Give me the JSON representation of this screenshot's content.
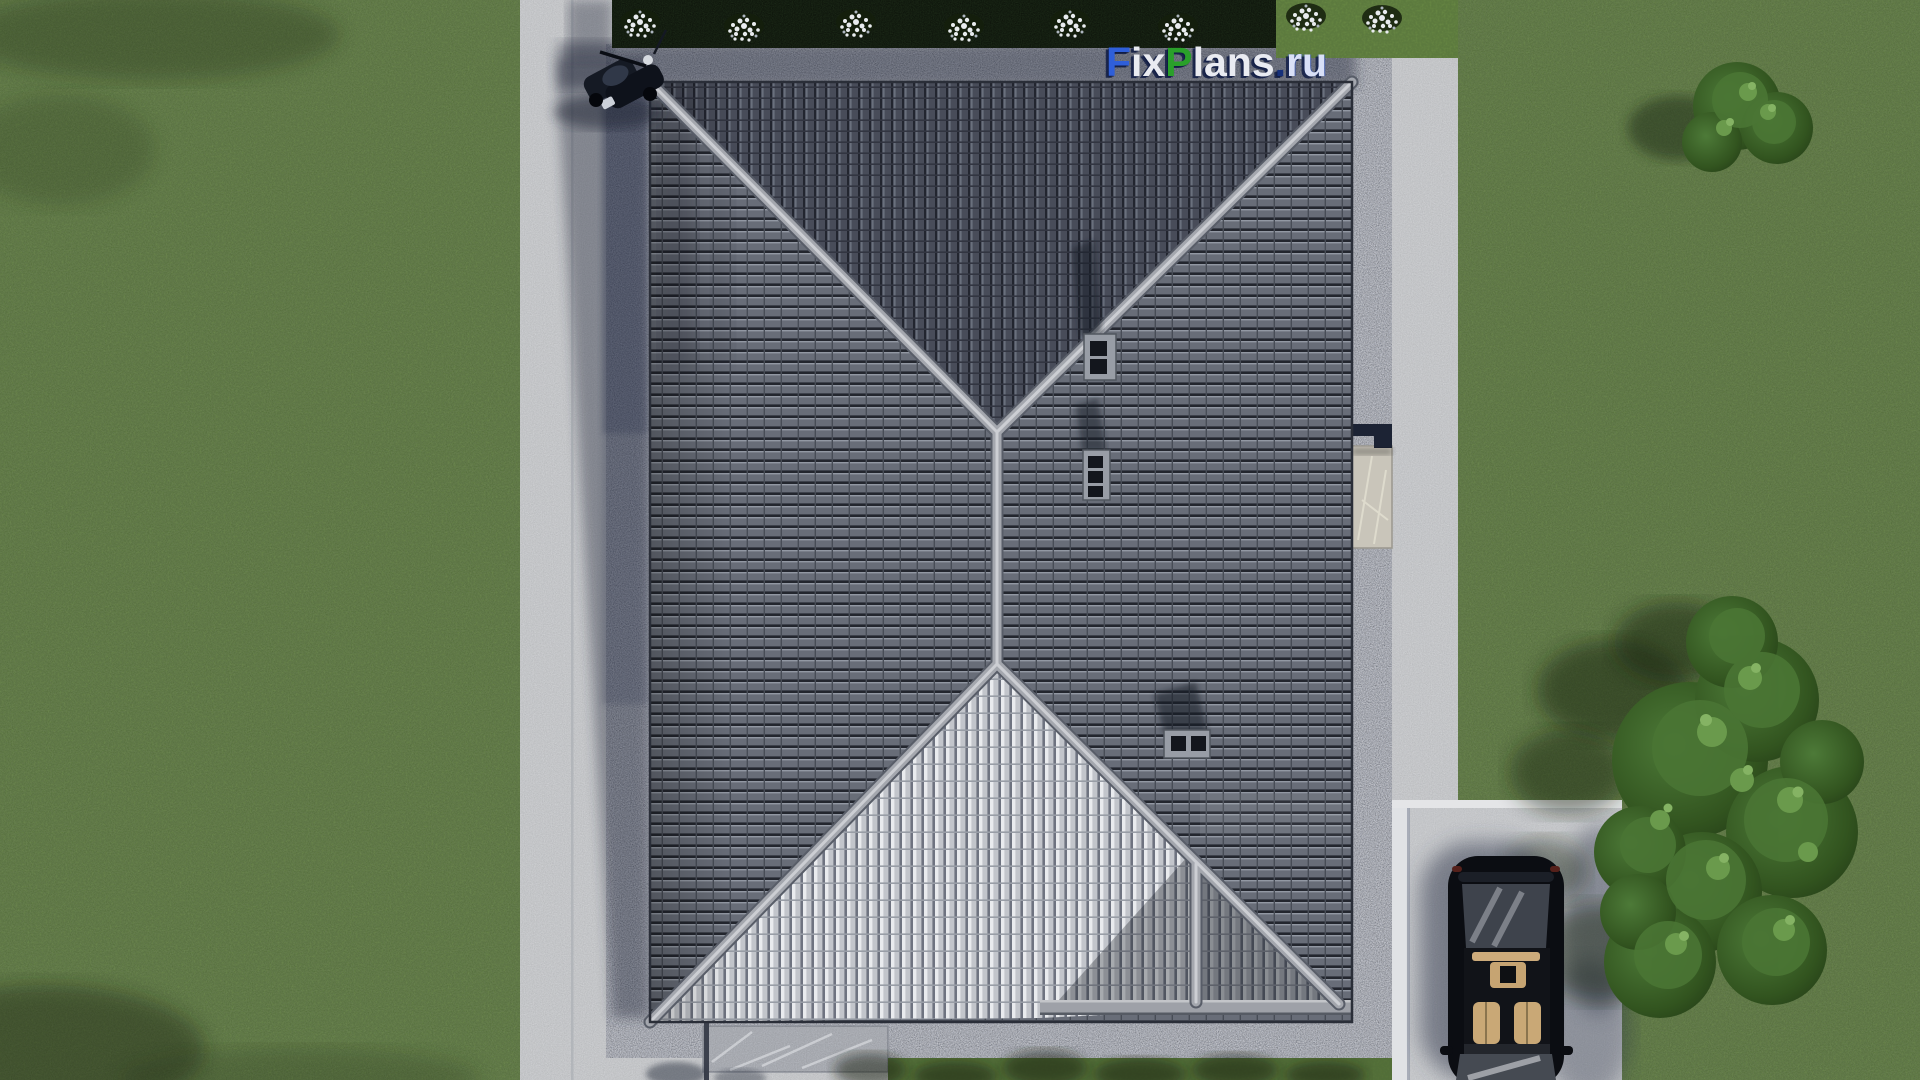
{
  "watermark": {
    "part_f": "F",
    "part_ix": "ix",
    "part_p": "P",
    "part_lans": "lans",
    "part_dot": ".",
    "part_ru": "ru",
    "full_text": "FixPlans.ru",
    "colors": {
      "blue": "#2f5fd9",
      "white": "#e9ebf1",
      "green": "#2aa02a",
      "navy": "#16307a",
      "lightblue": "#d9e0f6"
    }
  },
  "scene": {
    "description": "Aerial top-down 3D architectural render: house with dark hipped tile roof, concrete walkways, pebble drain border, driveway with black car, lawn, flowering hedge and trees",
    "colors": {
      "lawn": "#5f7d3d",
      "hedge": "#1f2e1a",
      "flowers": "#e9ecef",
      "concrete_pad": "#cbcdd0",
      "pebble_band": "#a9afc0",
      "driveway": "#d0d2d5",
      "roof_tiles_dark": "#666b76",
      "roof_face_bright": "#d6d8dc",
      "roof_ridge": "#a4a7ae",
      "chimney": "#989da6",
      "car_body": "#0b0d12",
      "car_interior": "#c9a876",
      "tree_foliage": "#3f6530"
    }
  }
}
